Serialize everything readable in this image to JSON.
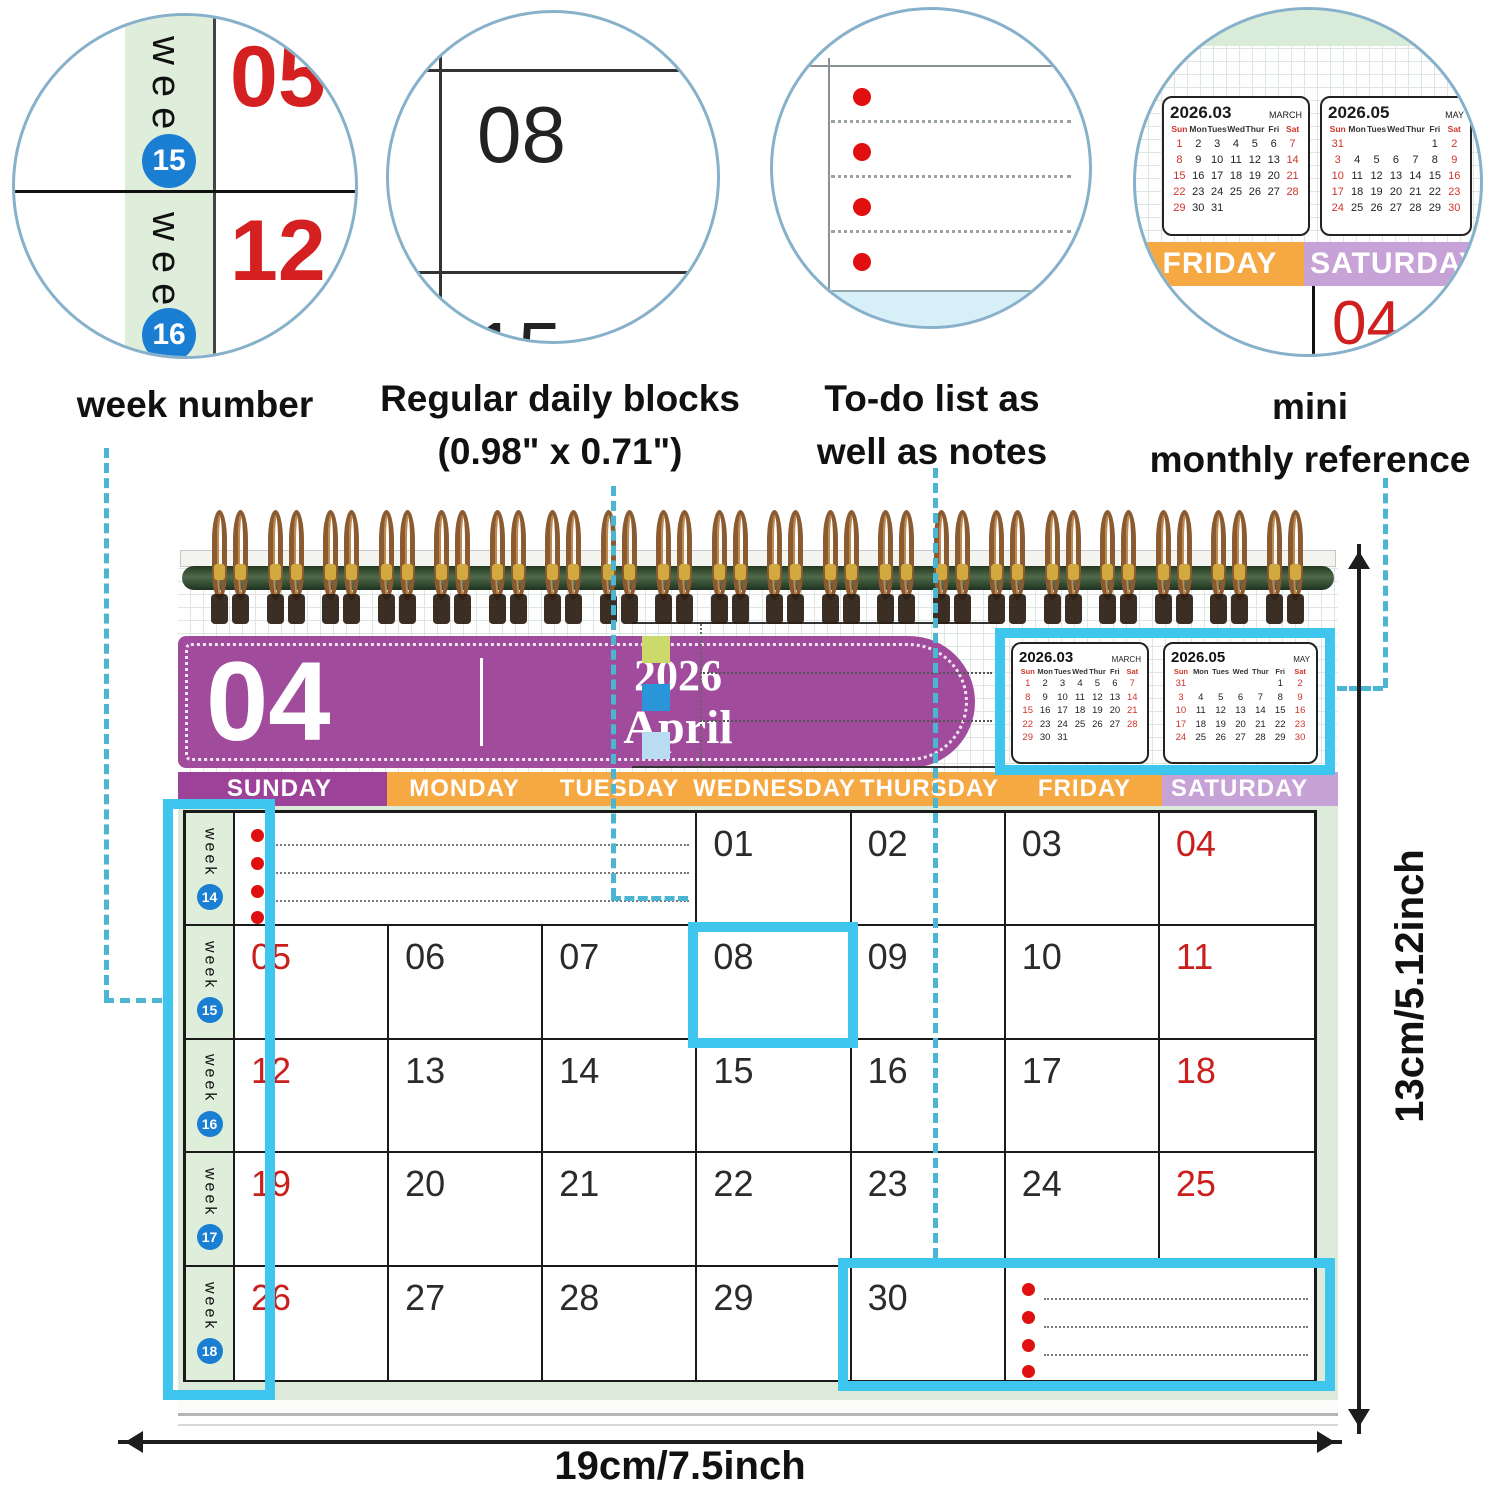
{
  "callouts": {
    "circle1": {
      "week_label": "week",
      "badge_top": "15",
      "day_top": "05",
      "badge_bottom": "16",
      "day_bottom": "12",
      "caption": "week number"
    },
    "circle2": {
      "day": "08",
      "day_below": "15",
      "caption_line1": "Regular daily blocks",
      "caption_line2": "(0.98\" x 0.71\")"
    },
    "circle3": {
      "caption_line1": "To-do list as",
      "caption_line2": "well as notes"
    },
    "circle4": {
      "friday_label": "FRIDAY",
      "saturday_label": "SATURDAY",
      "day": "04",
      "caption_line1": "mini",
      "caption_line2": "monthly reference"
    }
  },
  "header": {
    "month_number": "04",
    "year": "2026",
    "month_name": "April"
  },
  "mini_calendars": [
    {
      "title": "2026.03",
      "month_name": "MARCH",
      "day_headers": [
        "Sun",
        "Mon",
        "Tues",
        "Wed",
        "Thur",
        "Fri",
        "Sat"
      ],
      "rows": [
        [
          "1",
          "2",
          "3",
          "4",
          "5",
          "6",
          "7"
        ],
        [
          "8",
          "9",
          "10",
          "11",
          "12",
          "13",
          "14"
        ],
        [
          "15",
          "16",
          "17",
          "18",
          "19",
          "20",
          "21"
        ],
        [
          "22",
          "23",
          "24",
          "25",
          "26",
          "27",
          "28"
        ],
        [
          "29",
          "30",
          "31",
          "",
          "",
          "",
          ""
        ]
      ]
    },
    {
      "title": "2026.05",
      "month_name": "MAY",
      "day_headers": [
        "Sun",
        "Mon",
        "Tues",
        "Wed",
        "Thur",
        "Fri",
        "Sat"
      ],
      "rows": [
        [
          "31",
          "",
          "",
          "",
          "",
          "1",
          "2"
        ],
        [
          "3",
          "4",
          "5",
          "6",
          "7",
          "8",
          "9"
        ],
        [
          "10",
          "11",
          "12",
          "13",
          "14",
          "15",
          "16"
        ],
        [
          "17",
          "18",
          "19",
          "20",
          "21",
          "22",
          "23"
        ],
        [
          "24",
          "25",
          "26",
          "27",
          "28",
          "29",
          "30"
        ]
      ]
    }
  ],
  "day_headers": [
    "SUNDAY",
    "MONDAY",
    "TUESDAY",
    "WEDNESDAY",
    "THURSDAY",
    "FRIDAY",
    "SATURDAY"
  ],
  "grid": {
    "week_label": "week",
    "week_numbers": [
      "14",
      "15",
      "16",
      "17",
      "18"
    ],
    "days": [
      "01",
      "02",
      "03",
      "04",
      "05",
      "06",
      "07",
      "08",
      "09",
      "10",
      "11",
      "12",
      "13",
      "14",
      "15",
      "16",
      "17",
      "18",
      "19",
      "20",
      "21",
      "22",
      "23",
      "24",
      "25",
      "26",
      "27",
      "28",
      "29",
      "30"
    ]
  },
  "dimensions": {
    "width_label": "19cm/7.5inch",
    "height_label": "13cm/5.12inch"
  },
  "colors": {
    "capsule_purple": "#a14b9d",
    "sunday_purple": "#9c4299",
    "weekday_orange": "#f6a843",
    "saturday_lavender": "#c7a2d7",
    "page_green": "#dceada",
    "callout_cyan": "#3fc6ef",
    "connector_teal": "#4cb6d2",
    "badge_blue": "#1a7fd2",
    "red_day": "#c9201d",
    "todo_dot_red": "#e01010"
  }
}
